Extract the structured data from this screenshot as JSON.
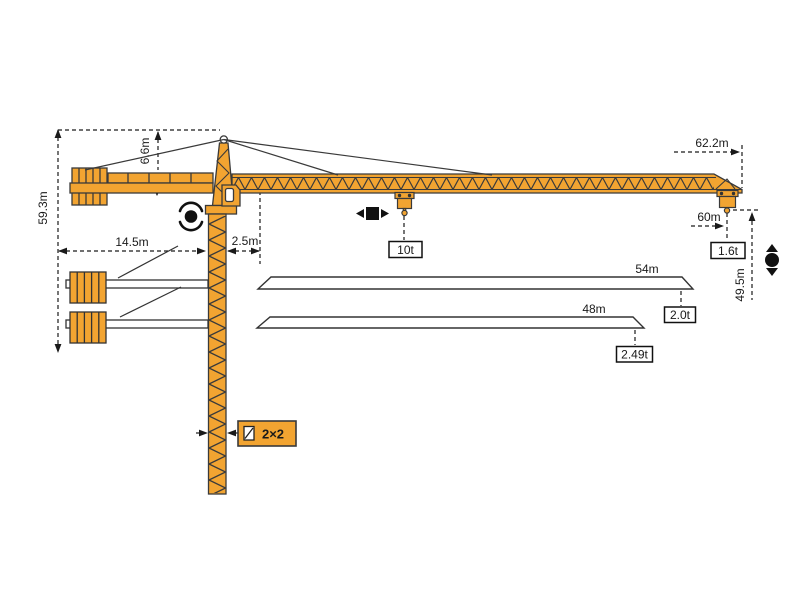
{
  "diagram": {
    "type": "tower-crane-specification-drawing",
    "colors": {
      "crane_body": "#F2A431",
      "outline": "#3A3A3A",
      "dimension": "#1A1A1A",
      "background": "#FFFFFF"
    },
    "labels": {
      "total_height": "59.3m",
      "tower_head_height": "6.6m",
      "counter_jib_radius": "14.5m",
      "slew_offset": "2.5m",
      "max_jib_radius": "62.2m",
      "tip_radius": "60m",
      "hook_height": "49.5m",
      "max_capacity": "10t",
      "tip_capacity_62m": "1.6t",
      "jib_option_54": "54m",
      "tip_capacity_54m": "2.0t",
      "jib_option_48": "48m",
      "tip_capacity_48m": "2.49t",
      "mast_section": "2×2"
    },
    "icons": [
      "slewing-icon",
      "trolley-travel-icon",
      "hoist-icon",
      "mast-section-icon"
    ]
  }
}
